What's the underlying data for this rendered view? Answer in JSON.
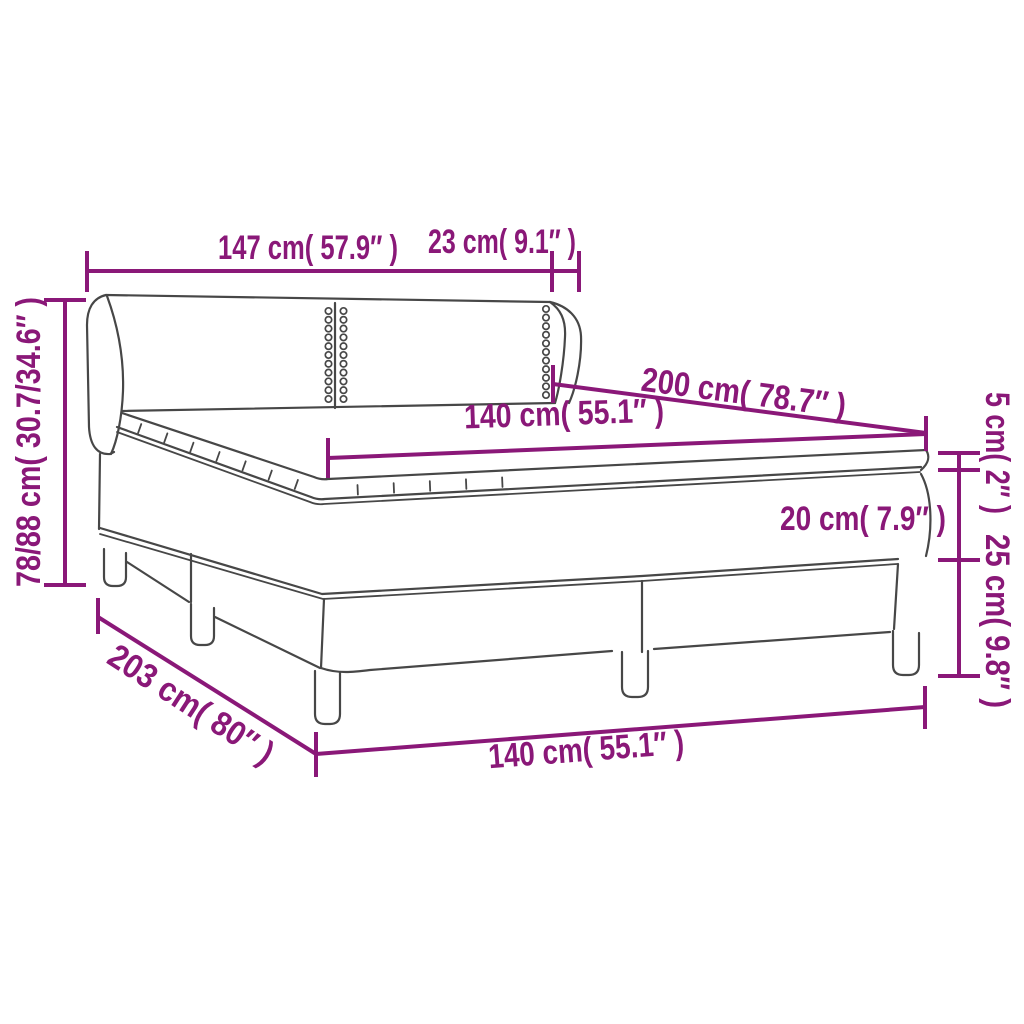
{
  "diagram": {
    "type": "product-dimension-diagram",
    "subject": "box spring bed with winged headboard, mattress and topper",
    "colors": {
      "dimension_accent": "#8A1878",
      "line_art": "#474747",
      "background": "#FFFFFF"
    },
    "dimensions": {
      "headboard_width": "147 cm( 57.9″ )",
      "headboard_side_depth": "23 cm( 9.1″ )",
      "headboard_height_range": "78/88 cm( 30.7/34.6″ )",
      "bed_length": "200 cm( 78.7″ )",
      "mattress_width": "140 cm( 55.1″ )",
      "topper_height": "5 cm( 2″ )",
      "mattress_height": "20 cm( 7.9″ )",
      "base_height": "25 cm( 9.8″ )",
      "total_length": "203 cm( 80″ )",
      "base_width": "140 cm( 55.1″ )"
    }
  }
}
